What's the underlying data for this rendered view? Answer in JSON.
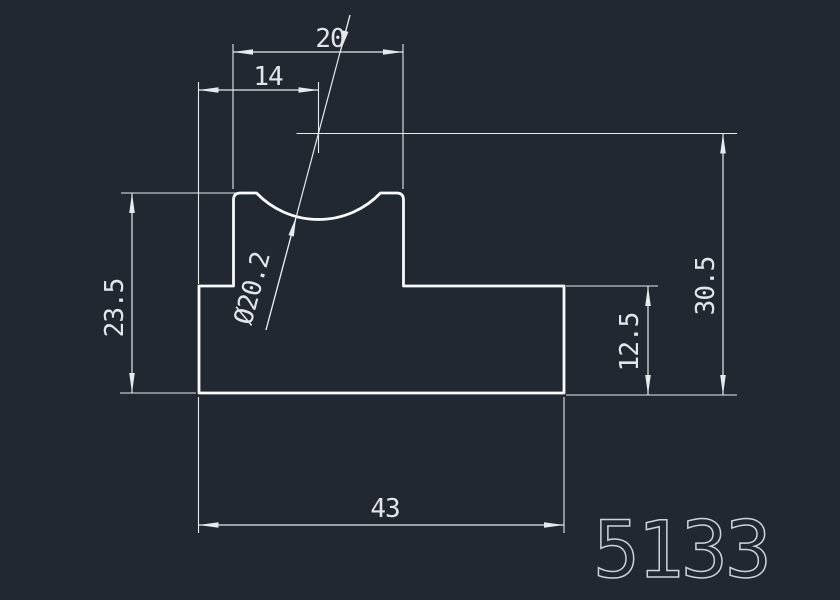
{
  "colors": {
    "bg": "#222831",
    "outline": "#f8fafb",
    "dim": "#e6e9ed",
    "text": "#e2e6ea",
    "pn": "#ccd2d9"
  },
  "drawing": {
    "type": "cad-profile-section",
    "dims": {
      "top_width": {
        "label": "20"
      },
      "left_width": {
        "label": "14"
      },
      "left_height": {
        "label": "23.5"
      },
      "groove_diameter": {
        "label": "Ø20.2"
      },
      "step_height": {
        "label": "12.5"
      },
      "overall_height": {
        "label": "30.5"
      },
      "overall_width": {
        "label": "43"
      }
    },
    "part_number": "5133"
  }
}
